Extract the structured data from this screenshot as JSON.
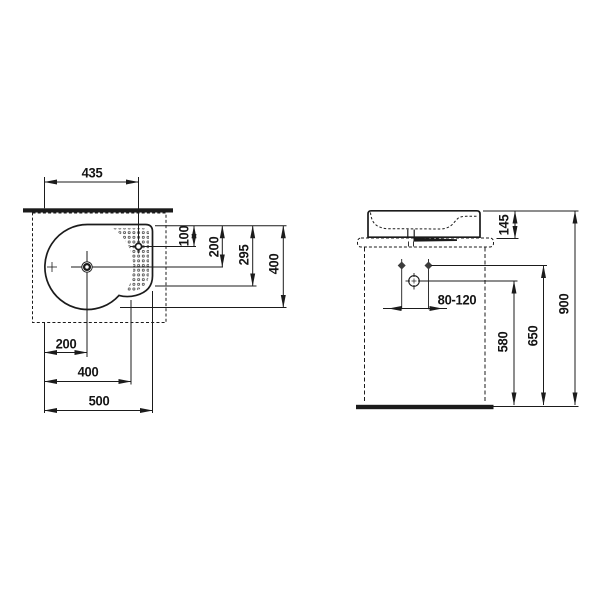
{
  "drawing": {
    "kind": "washbasin installation dimension drawing",
    "colors": {
      "ink": "#1b1b1b",
      "background": "#ffffff"
    },
    "plan_view": {
      "dims": {
        "taphole_from_left": "435",
        "taphole_from_back": "100",
        "drain_from_back": "200",
        "deck_depth": "295",
        "overall_depth": "400",
        "drain_from_left": "200",
        "bowl_width": "400",
        "overall_width": "500"
      }
    },
    "side_view": {
      "dims": {
        "basin_height": "145",
        "drain_offset_range": "80-120",
        "drain_height": "580",
        "fixing_height": "650",
        "rim_height": "900"
      }
    }
  }
}
